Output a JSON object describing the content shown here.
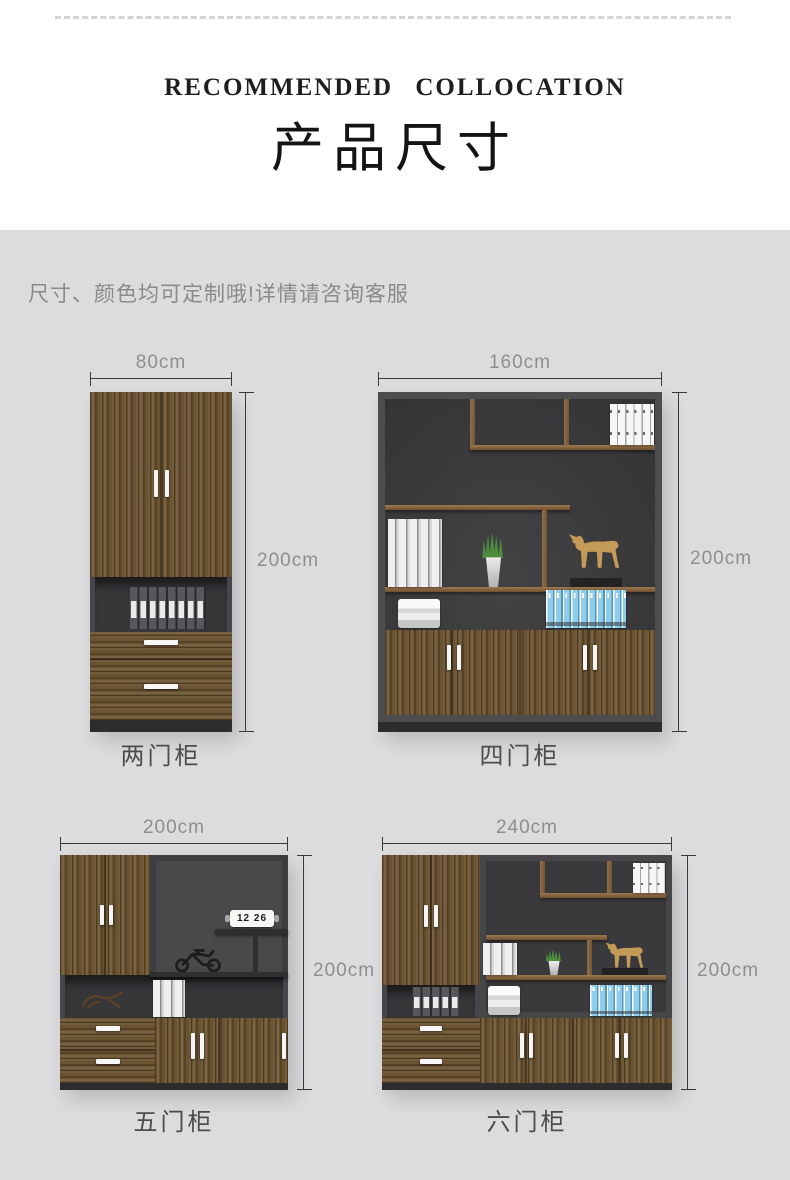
{
  "header": {
    "title_en": "RECOMMENDED  COLLOCATION",
    "title_cn": "产品尺寸"
  },
  "note": "尺寸、颜色均可定制哦!详情请咨询客服",
  "colors": {
    "page_background": "#dcdcde",
    "header_background": "#ffffff",
    "title_text": "#1e1e1e",
    "note_text": "#8a8a8a",
    "dimension_text": "#8e8e8e",
    "dimension_line": "#3a3a3a",
    "cabinet_wood": "#6a5331",
    "cabinet_interior_dark": "#39393b",
    "binder_blue": "#8ecdec"
  },
  "cabinets": [
    {
      "id": "two-door",
      "name": "两门柜",
      "width_label": "80cm",
      "height_label": "200cm"
    },
    {
      "id": "four-door",
      "name": "四门柜",
      "width_label": "160cm",
      "height_label": "200cm"
    },
    {
      "id": "five-door",
      "name": "五门柜",
      "width_label": "200cm",
      "height_label": "200cm",
      "clock_time": "12 26"
    },
    {
      "id": "six-door",
      "name": "六门柜",
      "width_label": "240cm",
      "height_label": "200cm"
    }
  ]
}
